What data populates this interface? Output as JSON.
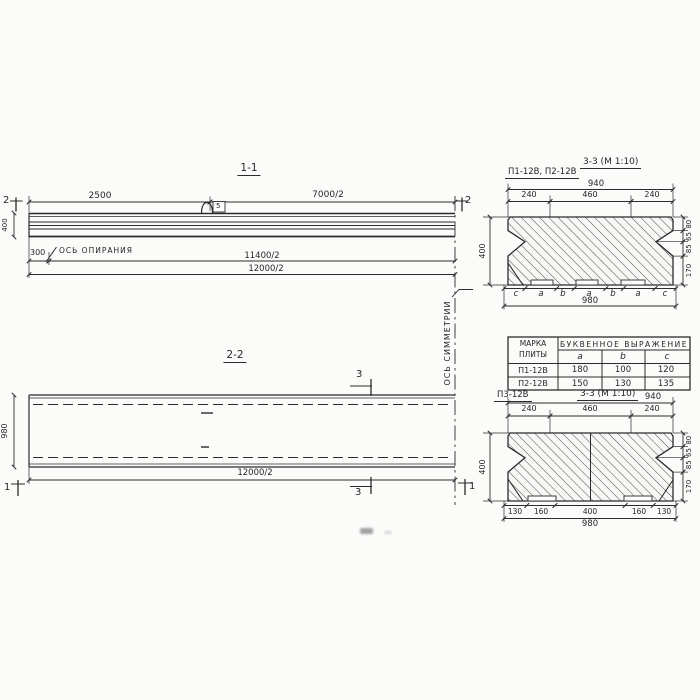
{
  "colors": {
    "ink": "#2b2b2b",
    "paper": "#fbfbfa"
  },
  "section_1_1": {
    "title": "1-1",
    "marker_left": "2",
    "marker_right": "2",
    "dim_top_left": "2500",
    "dim_top_right": "7000/2",
    "dim_height": "400",
    "dim_offset": "300",
    "bearing_axis_label": "ОСЬ ОПИРАНИЯ",
    "dim_mid": "11400/2",
    "dim_overall": "12000/2",
    "loop_tag": "5"
  },
  "section_2_2": {
    "title": "2-2",
    "dim_width": "980",
    "dim_overall": "12000/2",
    "marker_section_top": "3",
    "marker_section_bottom": "3",
    "marker_left": "1",
    "marker_right": "1"
  },
  "symmetry_axis_label": "ОСЬ СИММЕТРИИ",
  "section_3_3_top": {
    "subtitle": "П1-12В, П2-12В",
    "title": "3-3 (М 1:10)",
    "dim_top_overall": "940",
    "dims_top": [
      "240",
      "460",
      "240"
    ],
    "dim_height": "400",
    "dims_right": [
      "80",
      "65",
      "85",
      "170"
    ],
    "letter_row": [
      "c",
      "a",
      "b",
      "a",
      "b",
      "a",
      "c"
    ],
    "dim_bottom_overall": "980"
  },
  "plate_table": {
    "header_mark_line1": "МАРКА",
    "header_mark_line2": "ПЛИТЫ",
    "header_group": "БУКВЕННОЕ ВЫРАЖЕНИЕ",
    "subheaders": [
      "a",
      "b",
      "c"
    ],
    "rows": [
      {
        "mark": "П1-12В",
        "a": "180",
        "b": "100",
        "c": "120"
      },
      {
        "mark": "П2-12В",
        "a": "150",
        "b": "130",
        "c": "135"
      }
    ]
  },
  "section_3_3_bottom": {
    "subtitle": "П3-12В",
    "title": "3-3 (М 1:10)",
    "dim_top_overall": "940",
    "dims_top": [
      "240",
      "460",
      "240"
    ],
    "dim_height": "400",
    "dims_right": [
      "80",
      "65",
      "85",
      "170"
    ],
    "dims_bottom": [
      "130",
      "160",
      "400",
      "160",
      "130"
    ],
    "dim_bottom_overall": "980"
  }
}
